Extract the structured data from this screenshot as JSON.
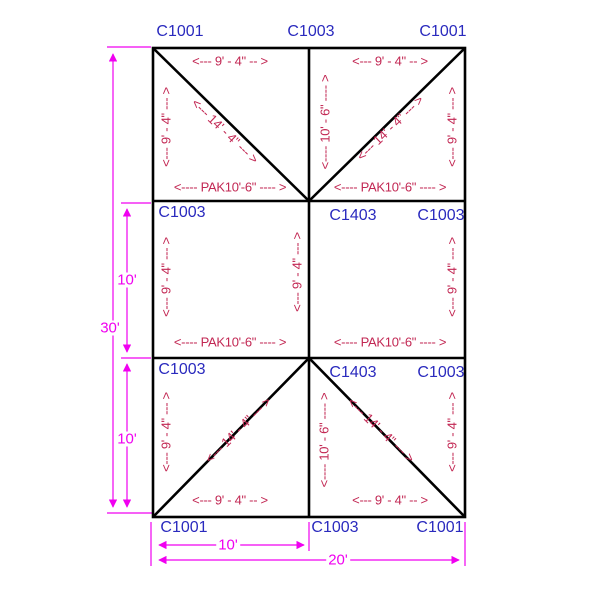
{
  "drawing": {
    "corner_labels": {
      "top_left": "C1001",
      "top_center": "C1003",
      "top_right": "C1001",
      "bottom_left": "C1001",
      "bottom_center": "C1003",
      "bottom_right": "C1001"
    },
    "cell_labels": {
      "mid_left": "C1003",
      "mid_right_inner": "C1403",
      "mid_right_outer": "C1003",
      "bottom_row_left": "C1003",
      "bottom_row_inner": "C1403",
      "bottom_row_outer": "C1003"
    },
    "dim_texts": {
      "rafter_9_4_h": "<--- 9' - 4\" -- >",
      "rafter_9_4_v": "<--- 9' - 4\" --- >",
      "diag_14_4": "<--- 14' - 4\" --- >",
      "mid_10_6": "<---- 10' - 6\" ---- >",
      "pak_10_6": "<---- PAK10'-6\" ---- >"
    },
    "overall_dims": {
      "height_total": "30'",
      "height_mid": "10'",
      "height_bottom": "10'",
      "width_half": "10'",
      "width_total": "20'"
    },
    "colors": {
      "part_label": "#2a2abe",
      "dim_text": "#c22753",
      "dim_line": "#f000f0",
      "frame_line": "#000000"
    }
  }
}
